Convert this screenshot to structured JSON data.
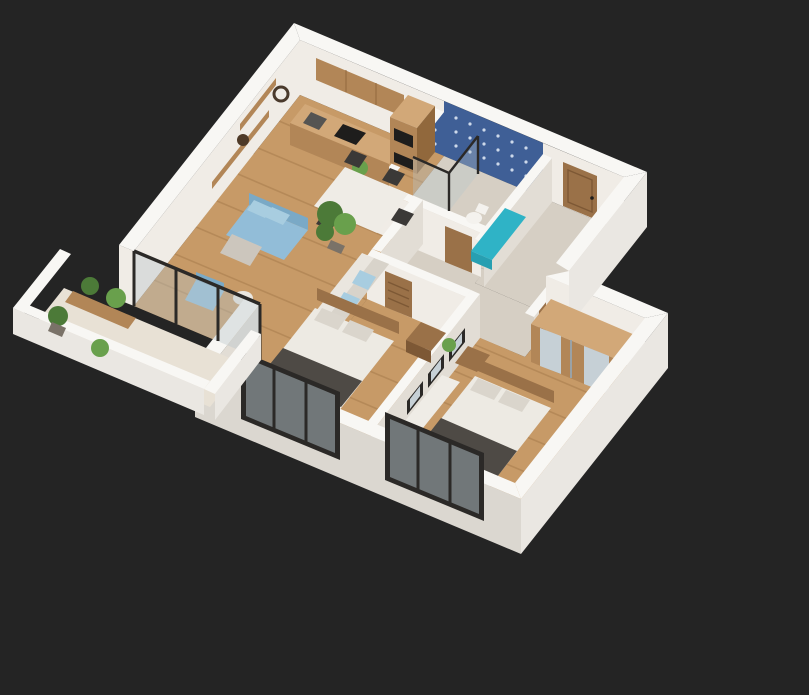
{
  "scene": {
    "type": "3d-isometric-floor-plan-render",
    "rooms": [
      "kitchen",
      "dining-area",
      "living-room",
      "bathroom",
      "entry-hall",
      "corridor",
      "bedroom-1",
      "bedroom-2",
      "balcony"
    ]
  },
  "colors": {
    "bg": "#242424",
    "wallTop": "#f8f7f4",
    "wallIn": "#f0ece6",
    "wallInSide": "#e2ddd5",
    "wallOut": "#eae7e2",
    "wallOutShade": "#dbd7d0",
    "floorWood": "#c79a67",
    "plankLine": "#a07547",
    "floorTile": "#d6cfc4",
    "floorBalcony": "#e8e1d5",
    "blueTile": "#3f5f96",
    "blueTileDark": "#33507f",
    "blueTilePat": "#cdd9ea",
    "frameBlack": "#2b2927",
    "glass": "#b8c6cb",
    "woodCab": "#b28657",
    "woodCabTop": "#d2a878",
    "woodCabDark": "#91683c",
    "woodDoor": "#9a7148",
    "woodDoorDark": "#7d5835",
    "appliance": "#1e1d1c",
    "steelGray": "#555452",
    "tableWhite": "#efece6",
    "chairDark": "#3b3937",
    "sofaBlue": "#92bdd8",
    "sofaBlueDark": "#7aa9c6",
    "pillowBlue": "#a8cde0",
    "couchWhite": "#eae6df",
    "couchShade": "#d8d3ca",
    "blanketGray": "#ccc6bd",
    "bedWhite": "#edeae3",
    "bedShade": "#dad5cc",
    "runnerDark": "#4e4a45",
    "plantGreen": "#4c7a38",
    "plantLight": "#69a04c",
    "potBrown": "#7a7268",
    "teal": "#2fb3c6",
    "tealDark": "#279fb1",
    "toiletWhite": "#f4f2ee",
    "mirror": "#c6d0d6",
    "metal": "#9aa2a6",
    "clockDark": "#4a3a2c",
    "bowlDark": "#4e3a28"
  }
}
